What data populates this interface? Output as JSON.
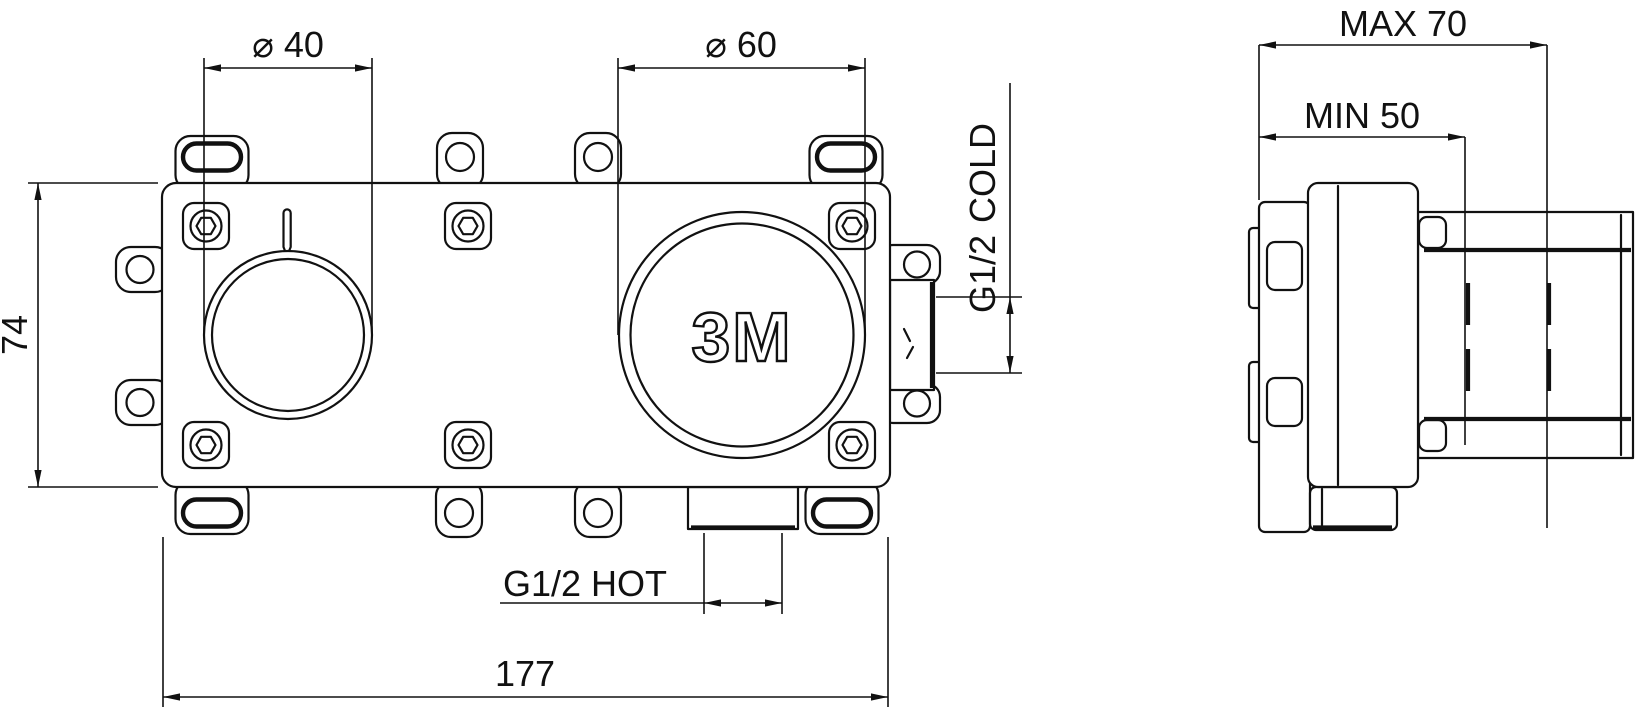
{
  "colors": {
    "line": "#111111",
    "background": "#ffffff"
  },
  "front_view": {
    "logo": "3M",
    "dimensions": {
      "small_bore_diameter": "⌀ 40",
      "large_bore_diameter": "⌀ 60",
      "body_height": "74",
      "body_width": "177"
    },
    "ports": {
      "cold_thread": "G1/2",
      "cold_label": "COLD",
      "hot_thread": "G1/2",
      "hot_label": "HOT"
    }
  },
  "side_view": {
    "dimensions": {
      "max_installation_depth": "MAX 70",
      "min_installation_depth": "MIN 50"
    }
  }
}
